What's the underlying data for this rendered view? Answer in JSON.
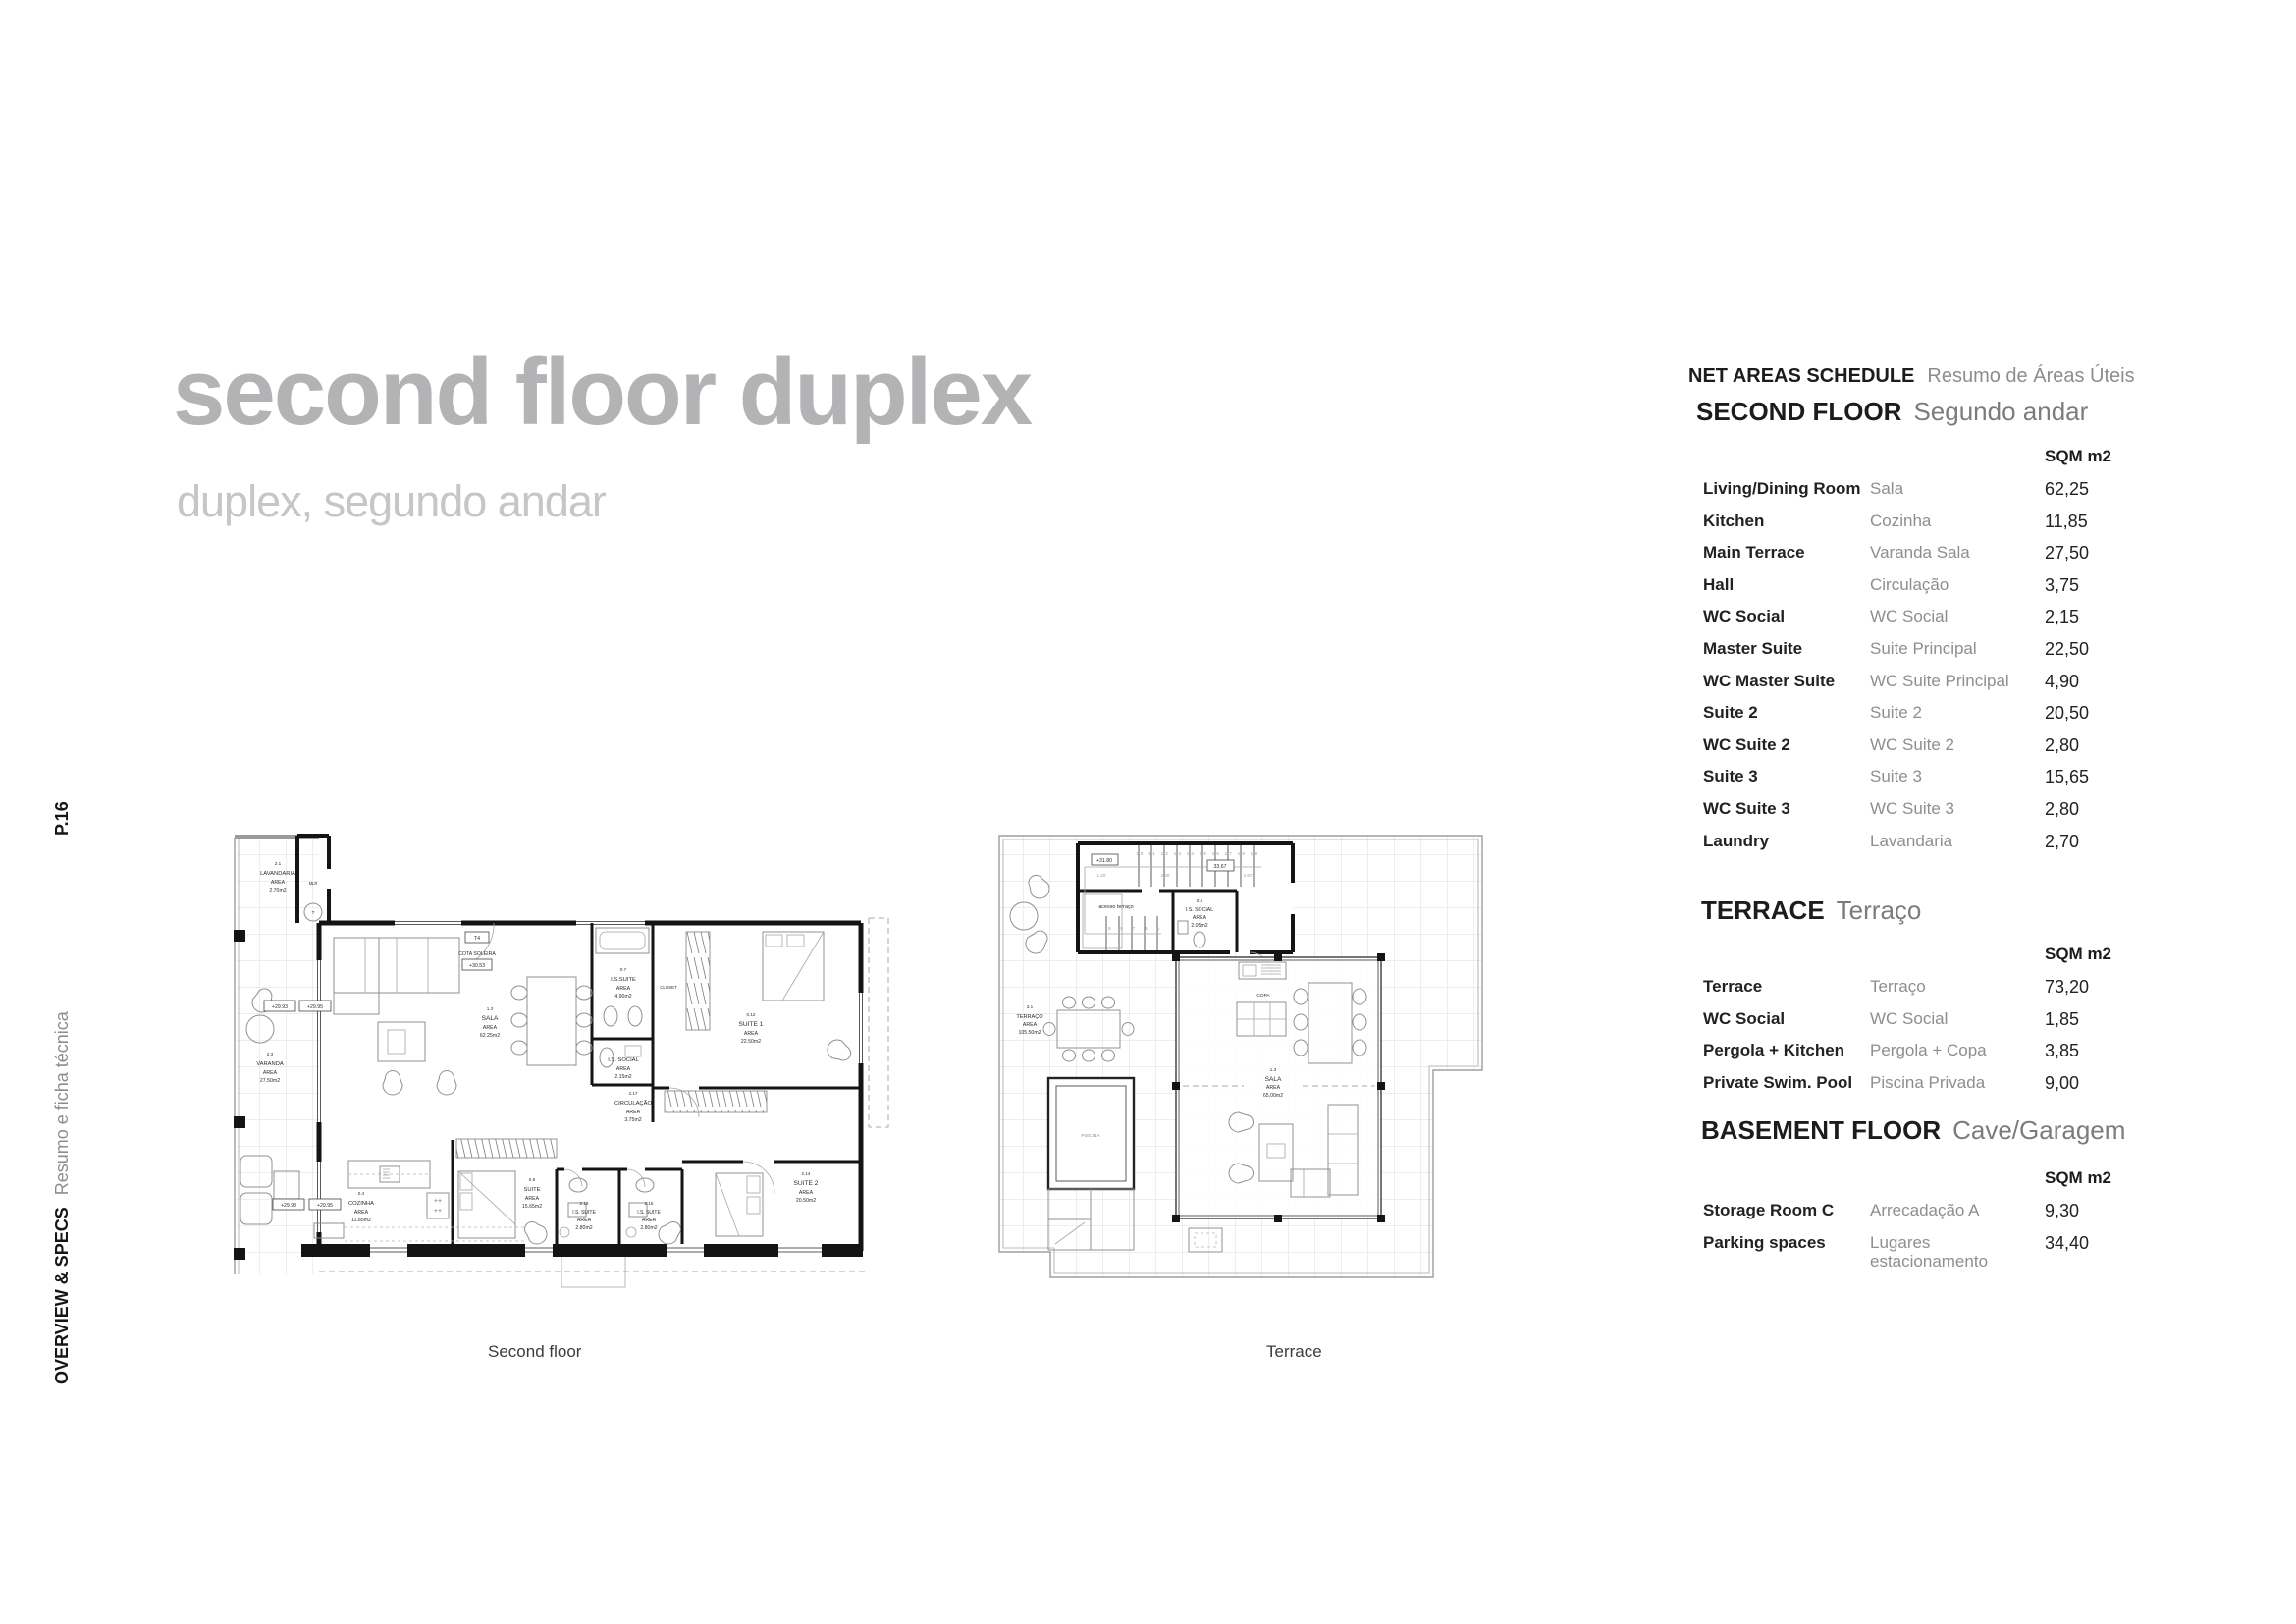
{
  "header": {
    "title": "second floor duplex",
    "subtitle": "duplex, segundo andar"
  },
  "sidebar": {
    "page_number": "P.16",
    "section": "OVERVIEW & SPECS",
    "section_pt": "Resumo e ficha técnica"
  },
  "schedule": {
    "heading": "NET AREAS SCHEDULE",
    "heading_pt": "Resumo de Áreas Úteis",
    "unit_label": "SQM m2",
    "sections": [
      {
        "title": "SECOND FLOOR",
        "title_pt": "Segundo andar",
        "rows": [
          {
            "en": "Living/Dining Room",
            "pt": "Sala",
            "value": "62,25"
          },
          {
            "en": "Kitchen",
            "pt": "Cozinha",
            "value": "11,85"
          },
          {
            "en": "Main Terrace",
            "pt": "Varanda Sala",
            "value": "27,50"
          },
          {
            "en": "Hall",
            "pt": "Circulação",
            "value": "3,75"
          },
          {
            "en": "WC Social",
            "pt": "WC Social",
            "value": "2,15"
          },
          {
            "en": "Master Suite",
            "pt": "Suite Principal",
            "value": "22,50"
          },
          {
            "en": "WC Master Suite",
            "pt": "WC Suite Principal",
            "value": "4,90"
          },
          {
            "en": "Suite 2",
            "pt": "Suite 2",
            "value": "20,50"
          },
          {
            "en": "WC Suite 2",
            "pt": "WC Suite 2",
            "value": "2,80"
          },
          {
            "en": "Suite 3",
            "pt": "Suite 3",
            "value": "15,65"
          },
          {
            "en": "WC Suite 3",
            "pt": "WC Suite 3",
            "value": "2,80"
          },
          {
            "en": "Laundry",
            "pt": "Lavandaria",
            "value": "2,70"
          }
        ]
      },
      {
        "title": "TERRACE",
        "title_pt": "Terraço",
        "rows": [
          {
            "en": "Terrace",
            "pt": "Terraço",
            "value": "73,20"
          },
          {
            "en": "WC Social",
            "pt": "WC Social",
            "value": "1,85"
          },
          {
            "en": "Pergola + Kitchen",
            "pt": "Pergola + Copa",
            "value": "3,85"
          },
          {
            "en": "Private Swim. Pool",
            "pt": "Piscina Privada",
            "value": "9,00"
          }
        ]
      },
      {
        "title": "BASEMENT FLOOR",
        "title_pt": "Cave/Garagem",
        "rows": [
          {
            "en": "Storage Room C",
            "pt": "Arrecadação A",
            "value": "9,30"
          },
          {
            "en": "Parking spaces",
            "pt": "Lugares estacionamento",
            "value": "34,40"
          }
        ]
      }
    ]
  },
  "plan_second": {
    "caption": "Second floor",
    "rooms": {
      "lavandaria": {
        "id": "2.1",
        "name": "LAVANDARIA",
        "area": "AREA",
        "size": "2.70m2"
      },
      "sala": {
        "id": "1.3",
        "name": "SALA",
        "area": "AREA",
        "size": "62.25m2"
      },
      "is_suite": {
        "id": "0.7",
        "name": "I.S.SUITE",
        "area": "AREA",
        "size": "4.90m2"
      },
      "suite1": {
        "id": "0.12",
        "name": "SUITE 1",
        "area": "AREA",
        "size": "22.50m2"
      },
      "is_social": {
        "name": "I.S. SOCIAL",
        "area": "AREA",
        "size": "2.15m2"
      },
      "circulacao": {
        "id": "2.17",
        "name": "CIRCULAÇÃO",
        "area": "AREA",
        "size": "3.75m2"
      },
      "varanda": {
        "id": "2.3",
        "name": "VARANDA",
        "area": "AREA",
        "size": "27.50m2"
      },
      "cozinha": {
        "id": "0.4",
        "name": "COZINHA",
        "area": "AREA",
        "size": "11.85m2"
      },
      "suite": {
        "id": "0.9",
        "name": "SUITE",
        "area": "AREA",
        "size": "15.65m2"
      },
      "is_suite_2": {
        "id": "2.16",
        "name": "I.S. SUITE",
        "area": "AREA",
        "size": "2.80m2"
      },
      "is_suite_3": {
        "id": "2.15",
        "name": "I.S. SUITE",
        "area": "AREA",
        "size": "2.80m2"
      },
      "suite2": {
        "id": "2.14",
        "name": "SUITE 2",
        "area": "AREA",
        "size": "20.50m2"
      }
    },
    "annotations": {
      "closet": "CLOSET",
      "mlr": "MLR",
      "t": "T",
      "t4": "T4",
      "cota": "COTA SOLEIRA",
      "cota_level": "+30.53",
      "level_a": "+29.93",
      "level_b": "+29.95"
    }
  },
  "plan_terrace": {
    "caption": "Terrace",
    "rooms": {
      "terraco": {
        "id": "3.1",
        "name": "TERRAÇO",
        "area": "AREA",
        "size": "105.50m2"
      },
      "sala": {
        "id": "1.3",
        "name": "SALA",
        "area": "AREA",
        "size": "65,00m2"
      },
      "is_social": {
        "id": "0.5",
        "name": "I.S. SOCIAL",
        "area": "AREA",
        "size": "2.05m2"
      },
      "piscina": {
        "name": "PISCINA"
      },
      "copa": {
        "name": "COPA"
      }
    },
    "annotations": {
      "level": "+31.80",
      "dim_box": "33.67",
      "dim_a": "1.20",
      "dim_b": "2.40",
      "dim_c": "2.67",
      "access": "acesso terraço",
      "stairs_upper": "10 11 12 13 14 15 16 17 18 19",
      "stairs_lower": "9 8 7 6 5"
    }
  }
}
